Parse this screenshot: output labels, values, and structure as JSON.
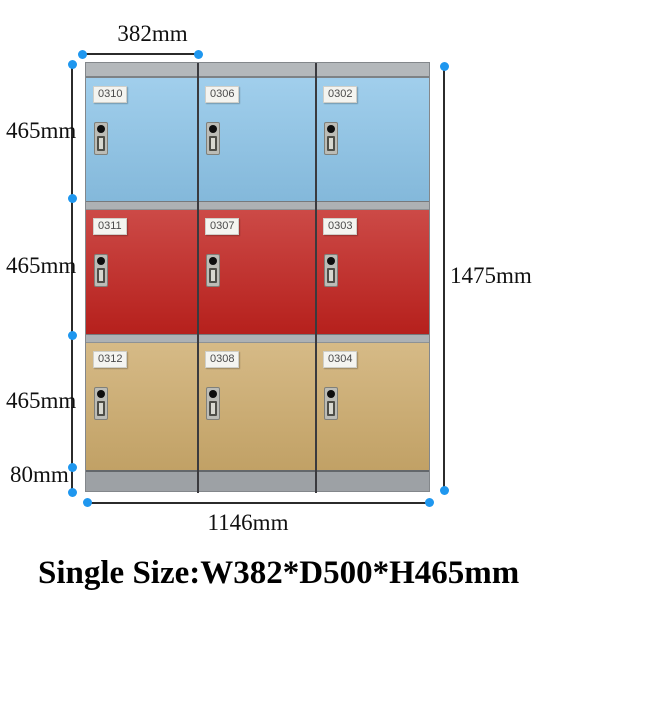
{
  "product": {
    "title": "Single Size:W382*D500*H465mm"
  },
  "dimensions": {
    "single_width": "382mm",
    "row_height_1": "465mm",
    "row_height_2": "465mm",
    "row_height_3": "465mm",
    "base_height": "80mm",
    "total_height": "1475mm",
    "total_width": "1146mm"
  },
  "cabinet": {
    "rows": [
      {
        "color": "#8cc4e8",
        "doors": [
          {
            "number": "0310"
          },
          {
            "number": "0306"
          },
          {
            "number": "0302"
          }
        ]
      },
      {
        "color": "#c1221e",
        "doors": [
          {
            "number": "0311"
          },
          {
            "number": "0307"
          },
          {
            "number": "0303"
          }
        ]
      },
      {
        "color": "#cdab6c",
        "doors": [
          {
            "number": "0312"
          },
          {
            "number": "0308"
          },
          {
            "number": "0304"
          }
        ]
      }
    ]
  },
  "colors": {
    "dimension_dot": "#1f97ef",
    "dimension_line": "#2b2b2b",
    "frame_gray": "#b4b8bb",
    "base_gray": "#9da1a5"
  }
}
